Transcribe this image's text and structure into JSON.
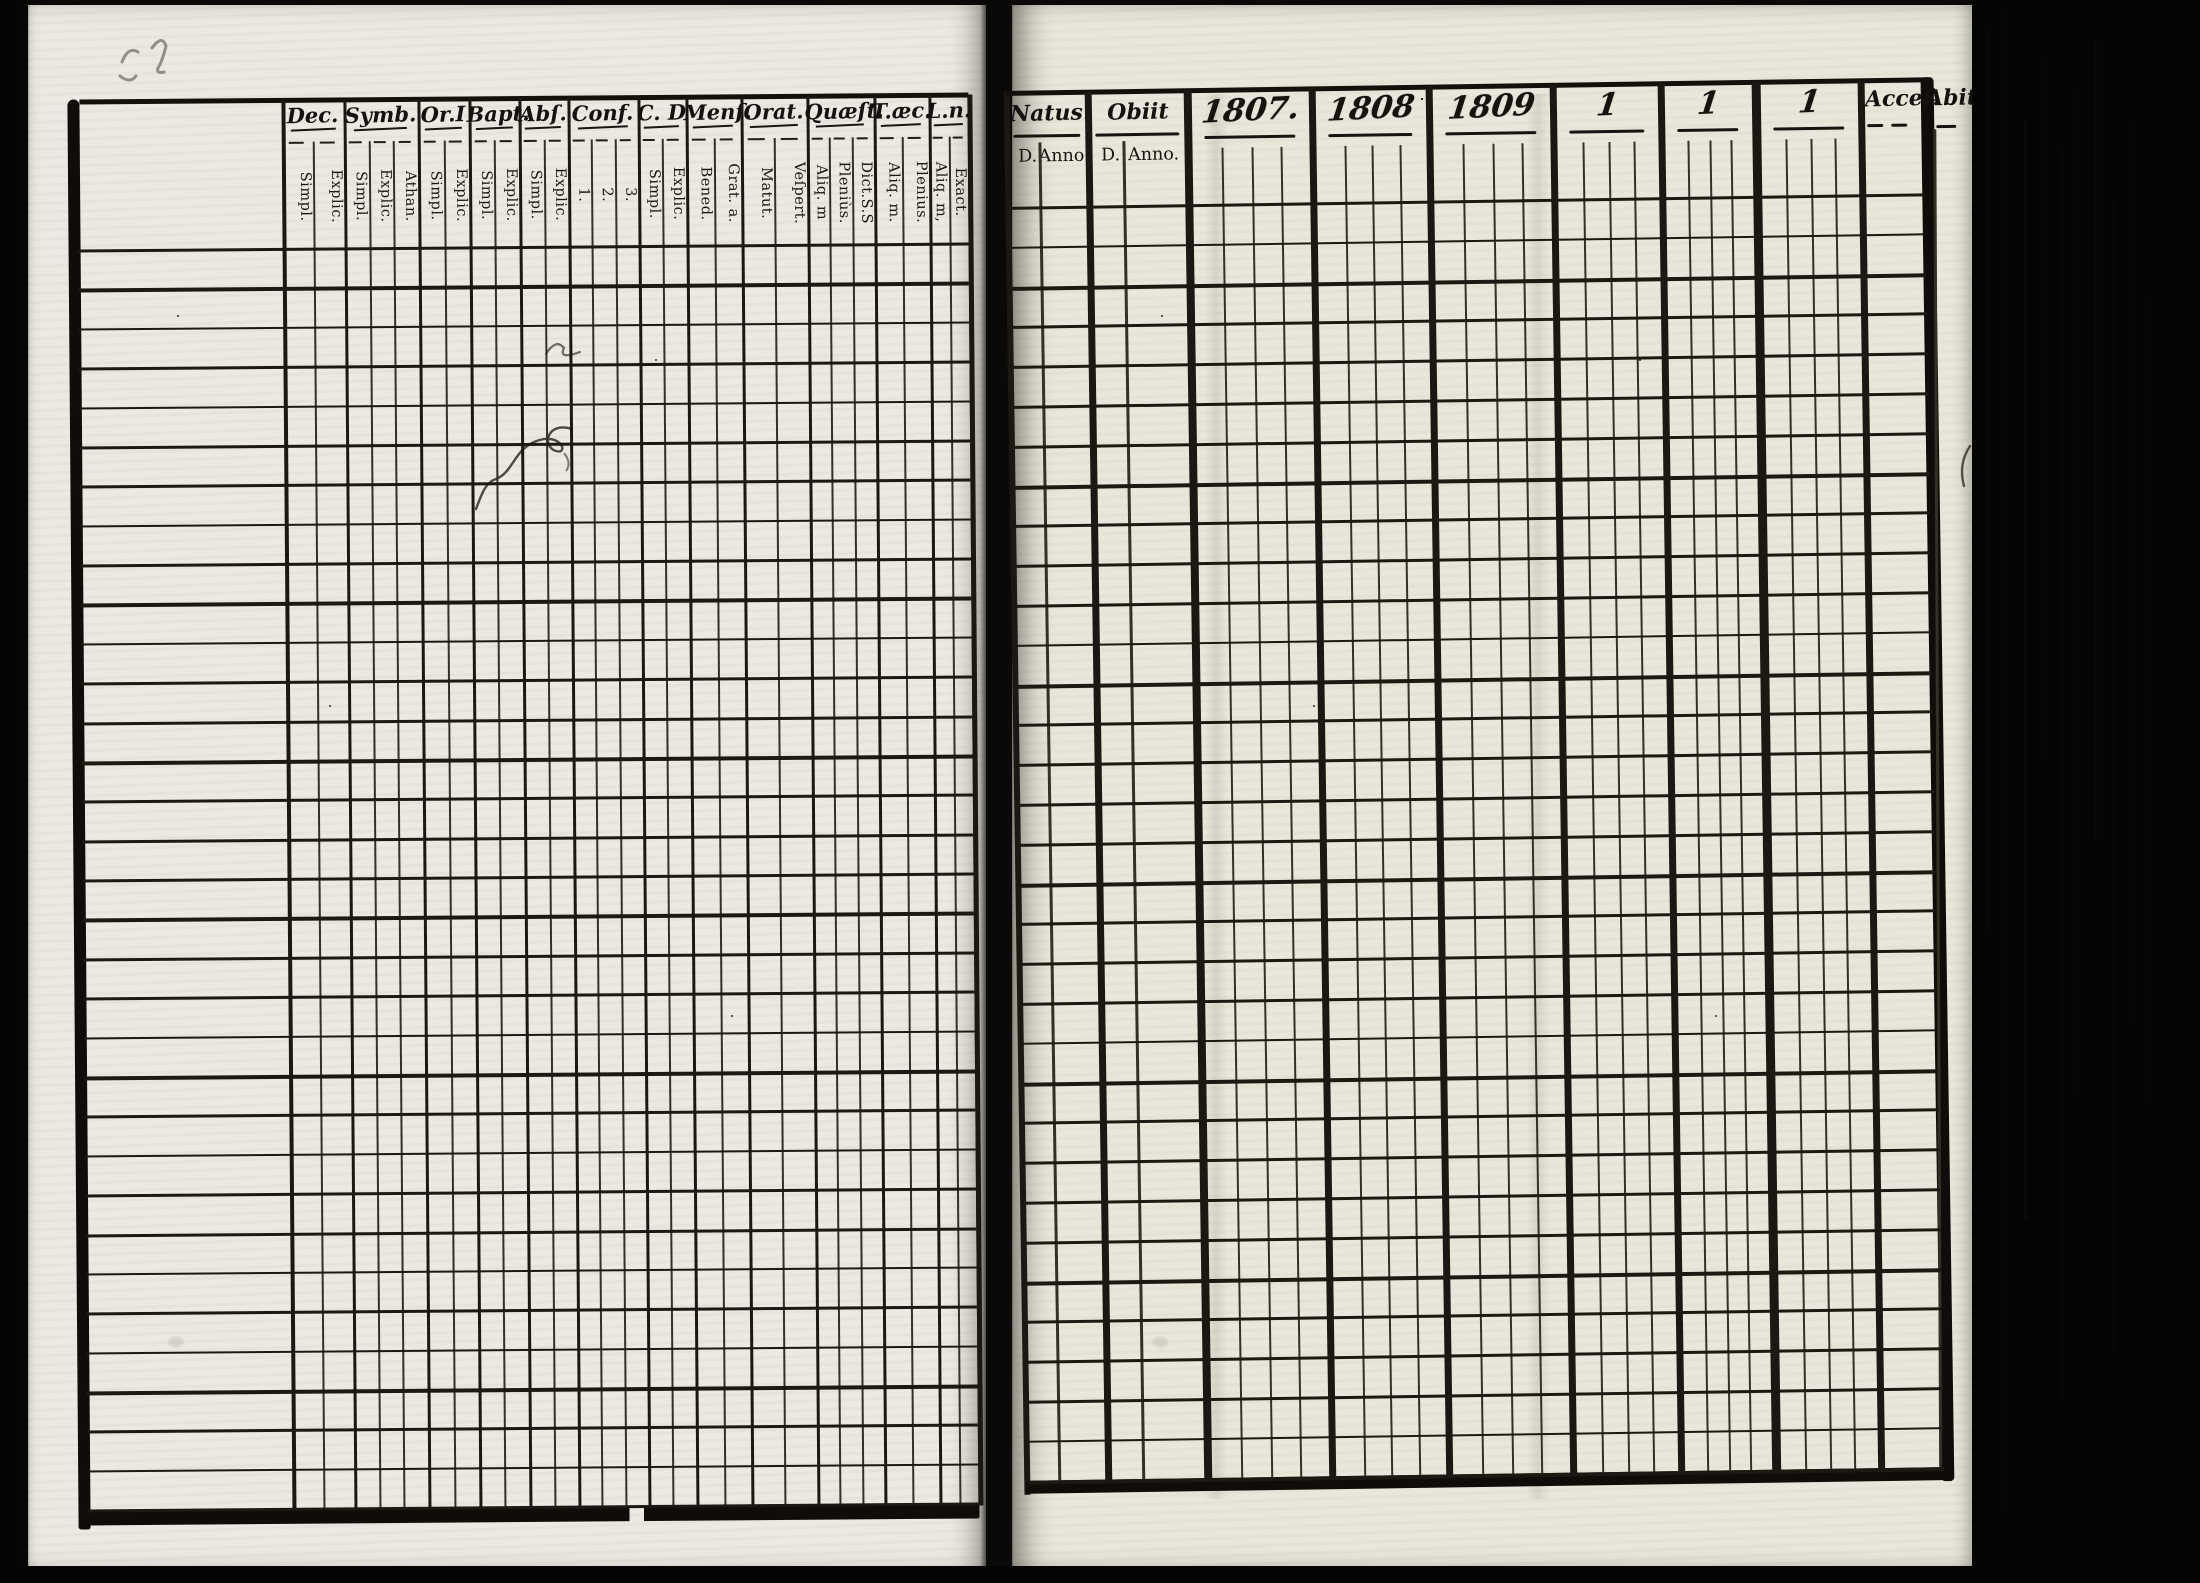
{
  "document": {
    "kind": "scanned printed register spread, blank ruled form",
    "ink_color": "#1b1712",
    "paper_color": "#ebe9e2"
  },
  "left_page": {
    "columns": [
      {
        "label": "Dec.",
        "subs": [
          "Simpl.",
          "Explic."
        ]
      },
      {
        "label": "Symb.",
        "subs": [
          "Simpl.",
          "Explic.",
          "Athan."
        ]
      },
      {
        "label": "Or.I",
        "subs": [
          "Simpl.",
          "Explic."
        ]
      },
      {
        "label": "Bapt.",
        "subs": [
          "Simpl.",
          "Explic."
        ]
      },
      {
        "label": "Abſ.",
        "subs": [
          "Simpl.",
          "Explic."
        ]
      },
      {
        "label": "Conf.",
        "subs": [
          "1.",
          "2.",
          "3."
        ]
      },
      {
        "label": "C. D",
        "subs": [
          "Simpl.",
          "Explic."
        ]
      },
      {
        "label": "Menſ.",
        "subs": [
          "Bened.",
          "Grat. a."
        ]
      },
      {
        "label": "Orat.",
        "subs": [
          "Matut.",
          "Veſpert."
        ]
      },
      {
        "label": "Quæſt.",
        "subs": [
          "Aliq. m",
          "Pleniùs.",
          "Dict.S.S"
        ]
      },
      {
        "label": "T.æc.",
        "subs": [
          "Aliq. m.",
          "Plenius."
        ]
      },
      {
        "label": "L.n.",
        "subs": [
          "Aliq. m,",
          "Exact."
        ]
      }
    ]
  },
  "right_page": {
    "record_columns": [
      {
        "label": "Natus.",
        "subs": [
          "D.",
          "Anno."
        ]
      },
      {
        "label": "Obiit",
        "subs": [
          "D.",
          "Anno."
        ]
      }
    ],
    "year_columns": [
      {
        "label": "1807."
      },
      {
        "label": "1808"
      },
      {
        "label": "1809"
      },
      {
        "label": "1"
      },
      {
        "label": "1"
      },
      {
        "label": "1"
      }
    ],
    "status_columns": [
      {
        "label": "Acceſ."
      },
      {
        "label": "Abit."
      }
    ]
  }
}
